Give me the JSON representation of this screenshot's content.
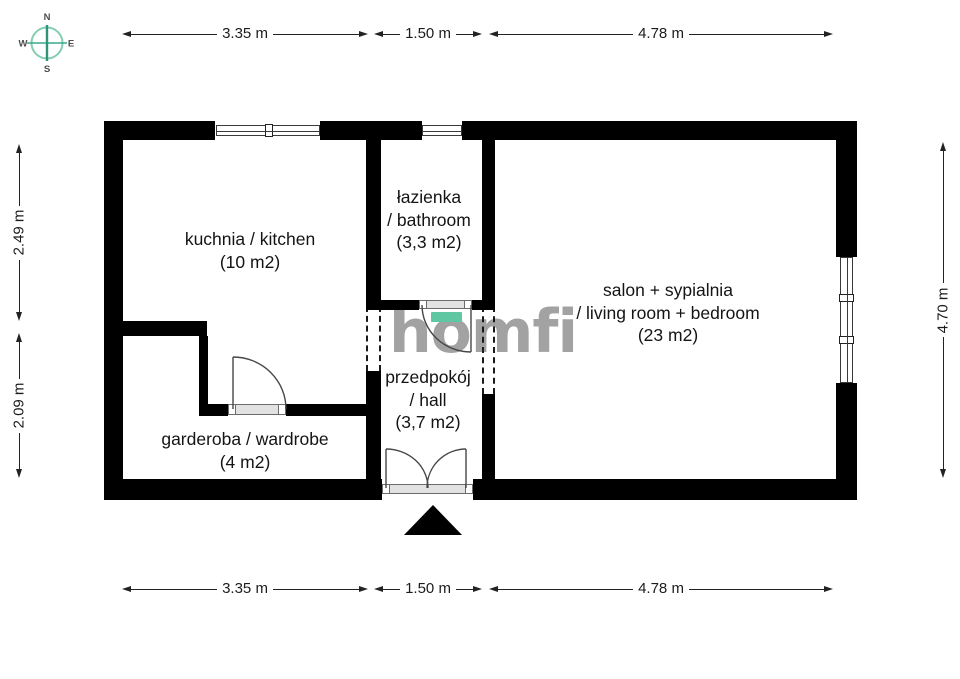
{
  "compass": {
    "n": "N",
    "e": "E",
    "s": "S",
    "w": "W"
  },
  "dims": {
    "top_left": "3.35 m",
    "top_mid": "1.50 m",
    "top_right": "4.78 m",
    "bottom_left": "3.35 m",
    "bottom_mid": "1.50 m",
    "bottom_right": "4.78 m",
    "left_upper": "2.49 m",
    "left_lower": "2.09 m",
    "right_side": "4.70 m"
  },
  "rooms": {
    "kitchen": {
      "name": "kuchnia / kitchen",
      "area": "(10 m2)"
    },
    "bathroom": {
      "name": "łazienka",
      "name2": "/ bathroom",
      "area": "(3,3 m2)"
    },
    "living": {
      "name": "salon + sypialnia",
      "name2": "/ living room + bedroom",
      "area": "(23 m2)"
    },
    "wardrobe": {
      "name": "garderoba / wardrobe",
      "area": "(4 m2)"
    },
    "hall": {
      "name": "przedpokój",
      "name2": "/ hall",
      "area": "(3,7 m2)"
    }
  },
  "logo": {
    "text": "homfi"
  },
  "colors": {
    "wall": "#000000",
    "logo_gray": "#a2a2a2",
    "accent_teal": "#5fc7a1",
    "compass_teal": "#3aa88a",
    "background": "#ffffff"
  }
}
